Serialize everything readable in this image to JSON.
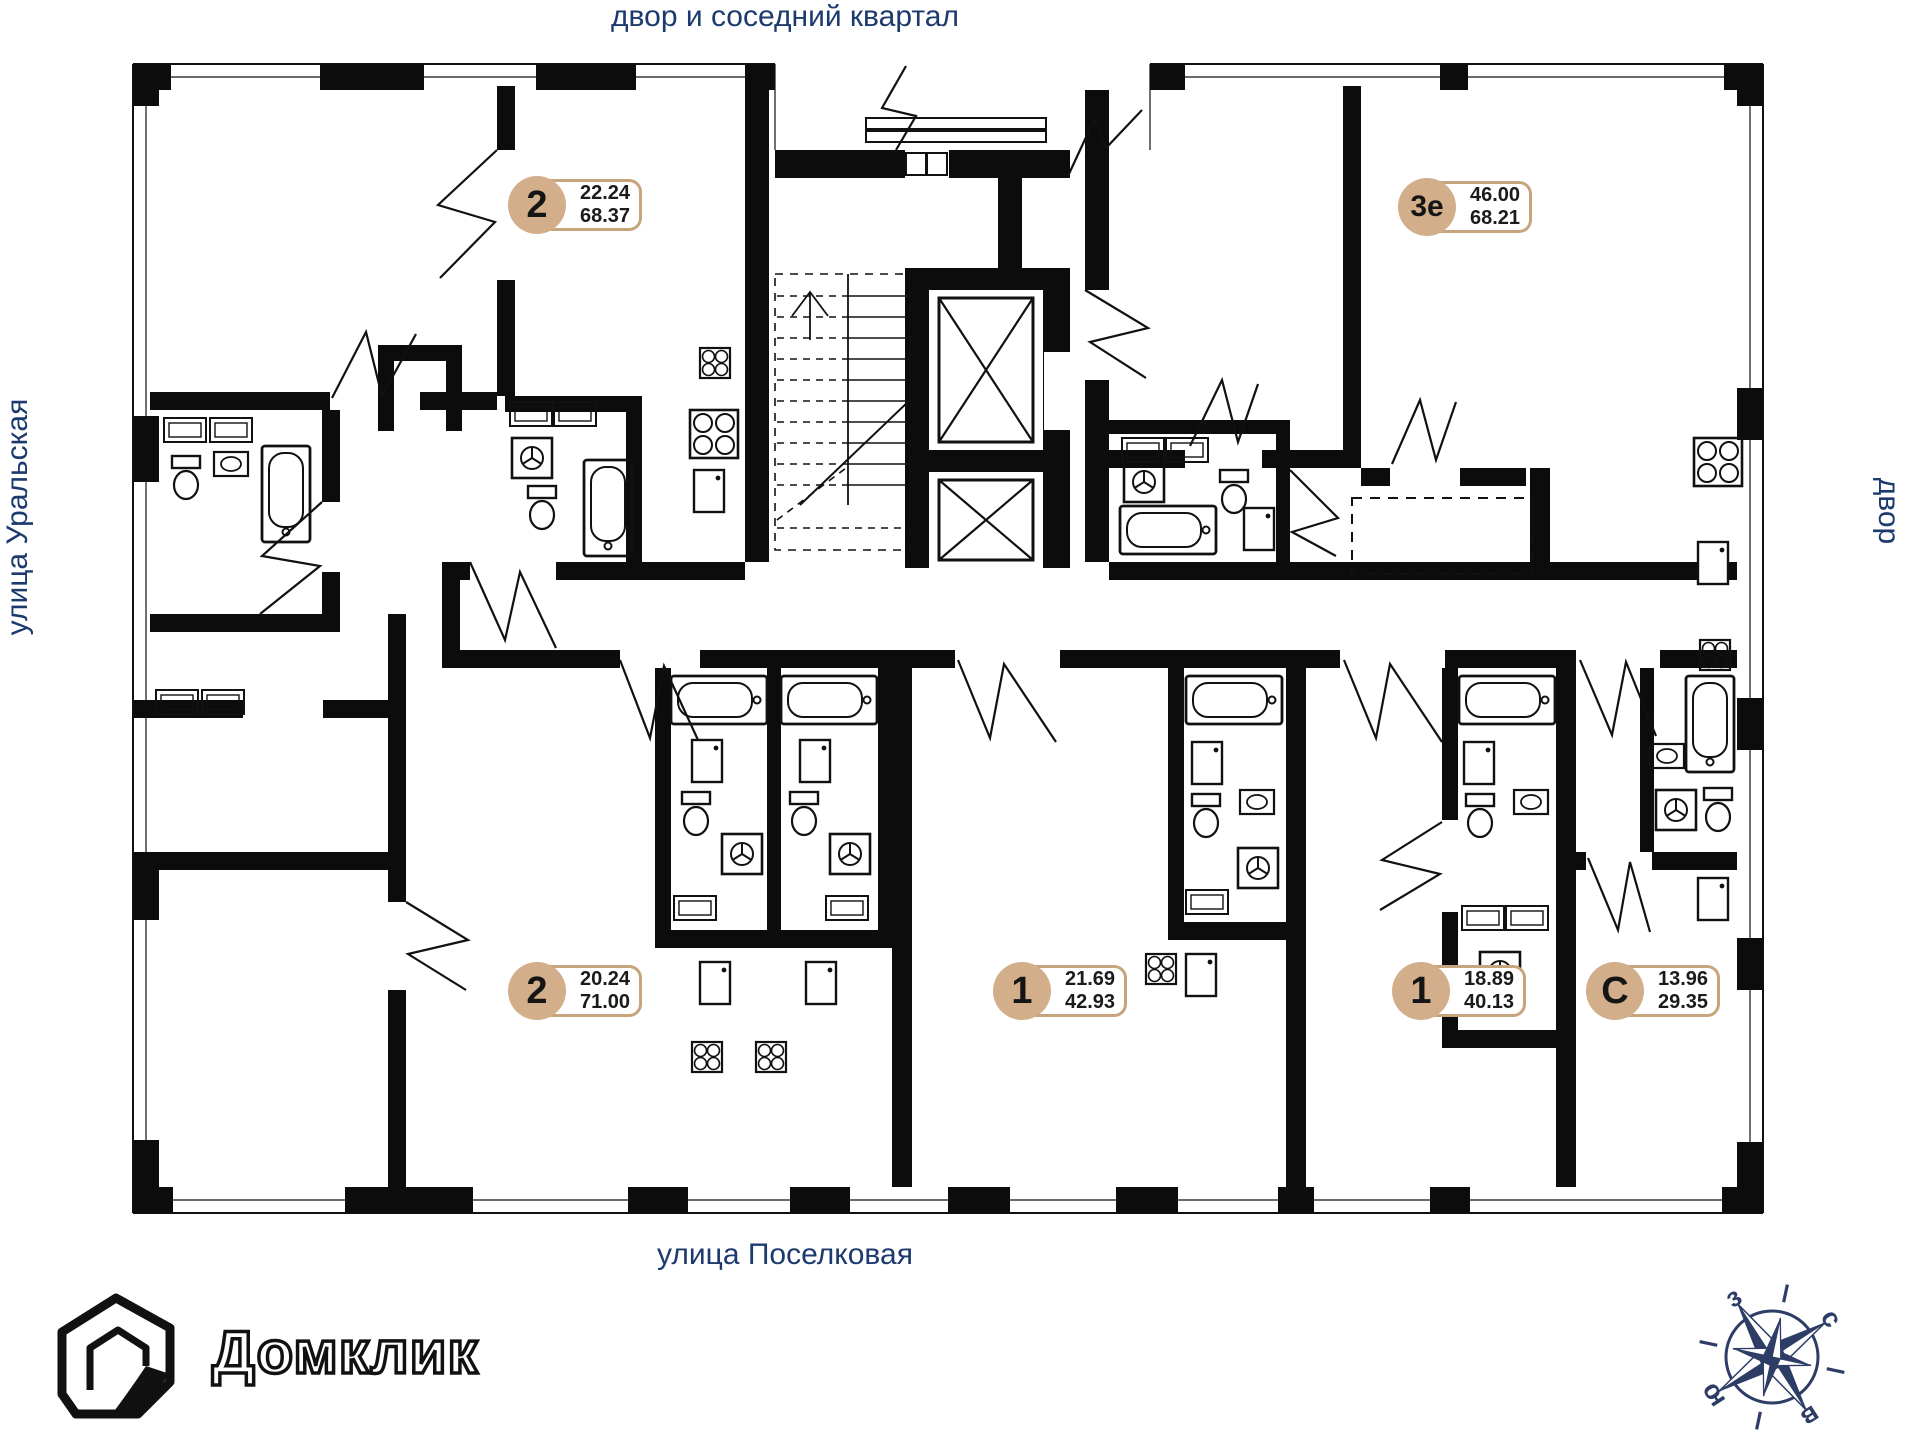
{
  "street_labels": {
    "top": "двор и соседний квартал",
    "left": "улица Уральская",
    "right": "двор",
    "bottom": "улица Поселковая"
  },
  "units": [
    {
      "type": "2",
      "area_living": "22.24",
      "area_total": "68.37"
    },
    {
      "type": "3е",
      "area_living": "46.00",
      "area_total": "68.21"
    },
    {
      "type": "2",
      "area_living": "20.24",
      "area_total": "71.00"
    },
    {
      "type": "1",
      "area_living": "21.69",
      "area_total": "42.93"
    },
    {
      "type": "1",
      "area_living": "18.89",
      "area_total": "40.13"
    },
    {
      "type": "С",
      "area_living": "13.96",
      "area_total": "29.35"
    }
  ],
  "logo": {
    "name": "Домклик"
  },
  "compass": {
    "north": "с",
    "east": "в",
    "south": "ю",
    "west": "з"
  },
  "colors": {
    "label_blue": "#1c3a6e",
    "badge_fill": "#d2ae8a",
    "badge_border": "#c7a47c",
    "compass_navy": "#2e3d66",
    "wall_black": "#0c0c0c"
  }
}
